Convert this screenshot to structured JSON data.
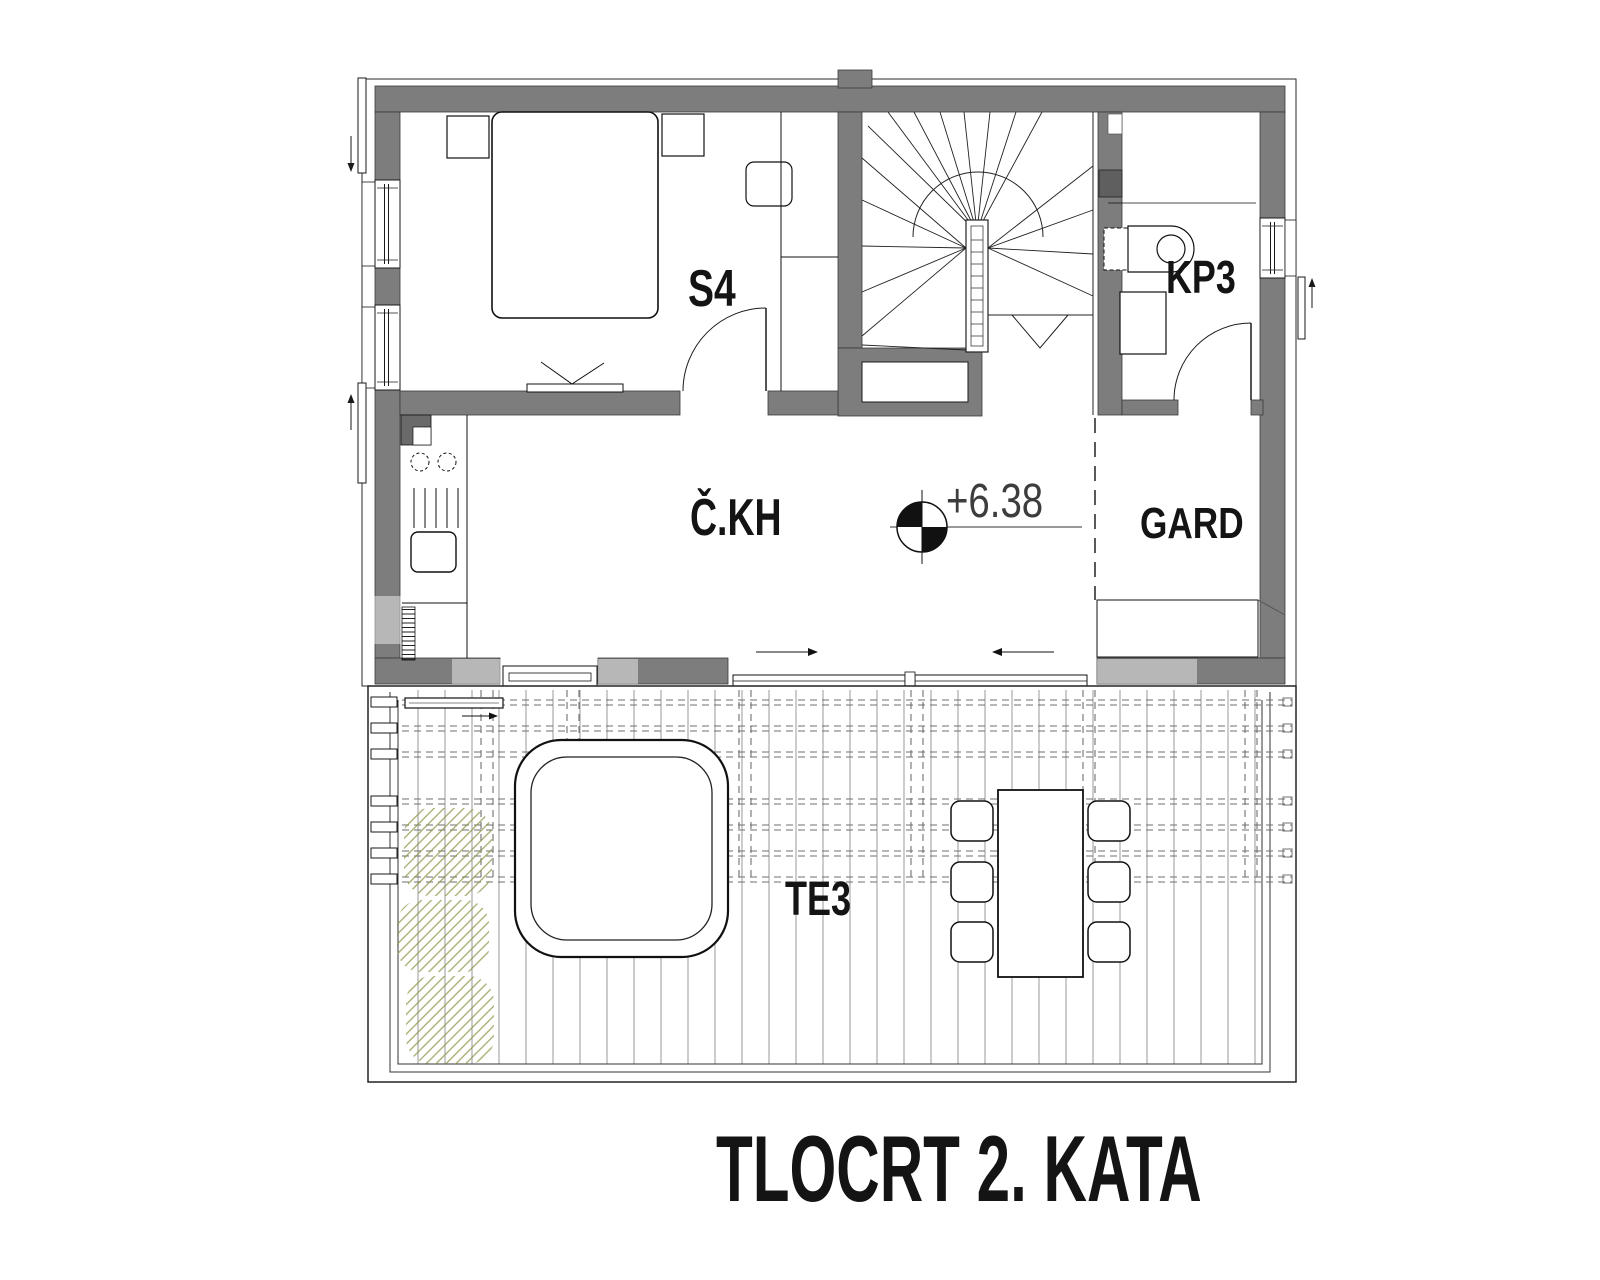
{
  "drawing": {
    "title": "TLOCRT 2. KATA",
    "rooms": {
      "bedroom": "S4",
      "bathroom": "KP3",
      "hall": "Č.KH",
      "wardrobe": "GARD",
      "terrace": "TE3"
    },
    "elevation_label": "+6.38",
    "colors": {
      "wall": "#7d7d7d",
      "line": "#1a1a1a",
      "deck_line": "#999999",
      "dashed_line": "#6f6f6f",
      "plant_hatch": "#8f9446"
    }
  }
}
